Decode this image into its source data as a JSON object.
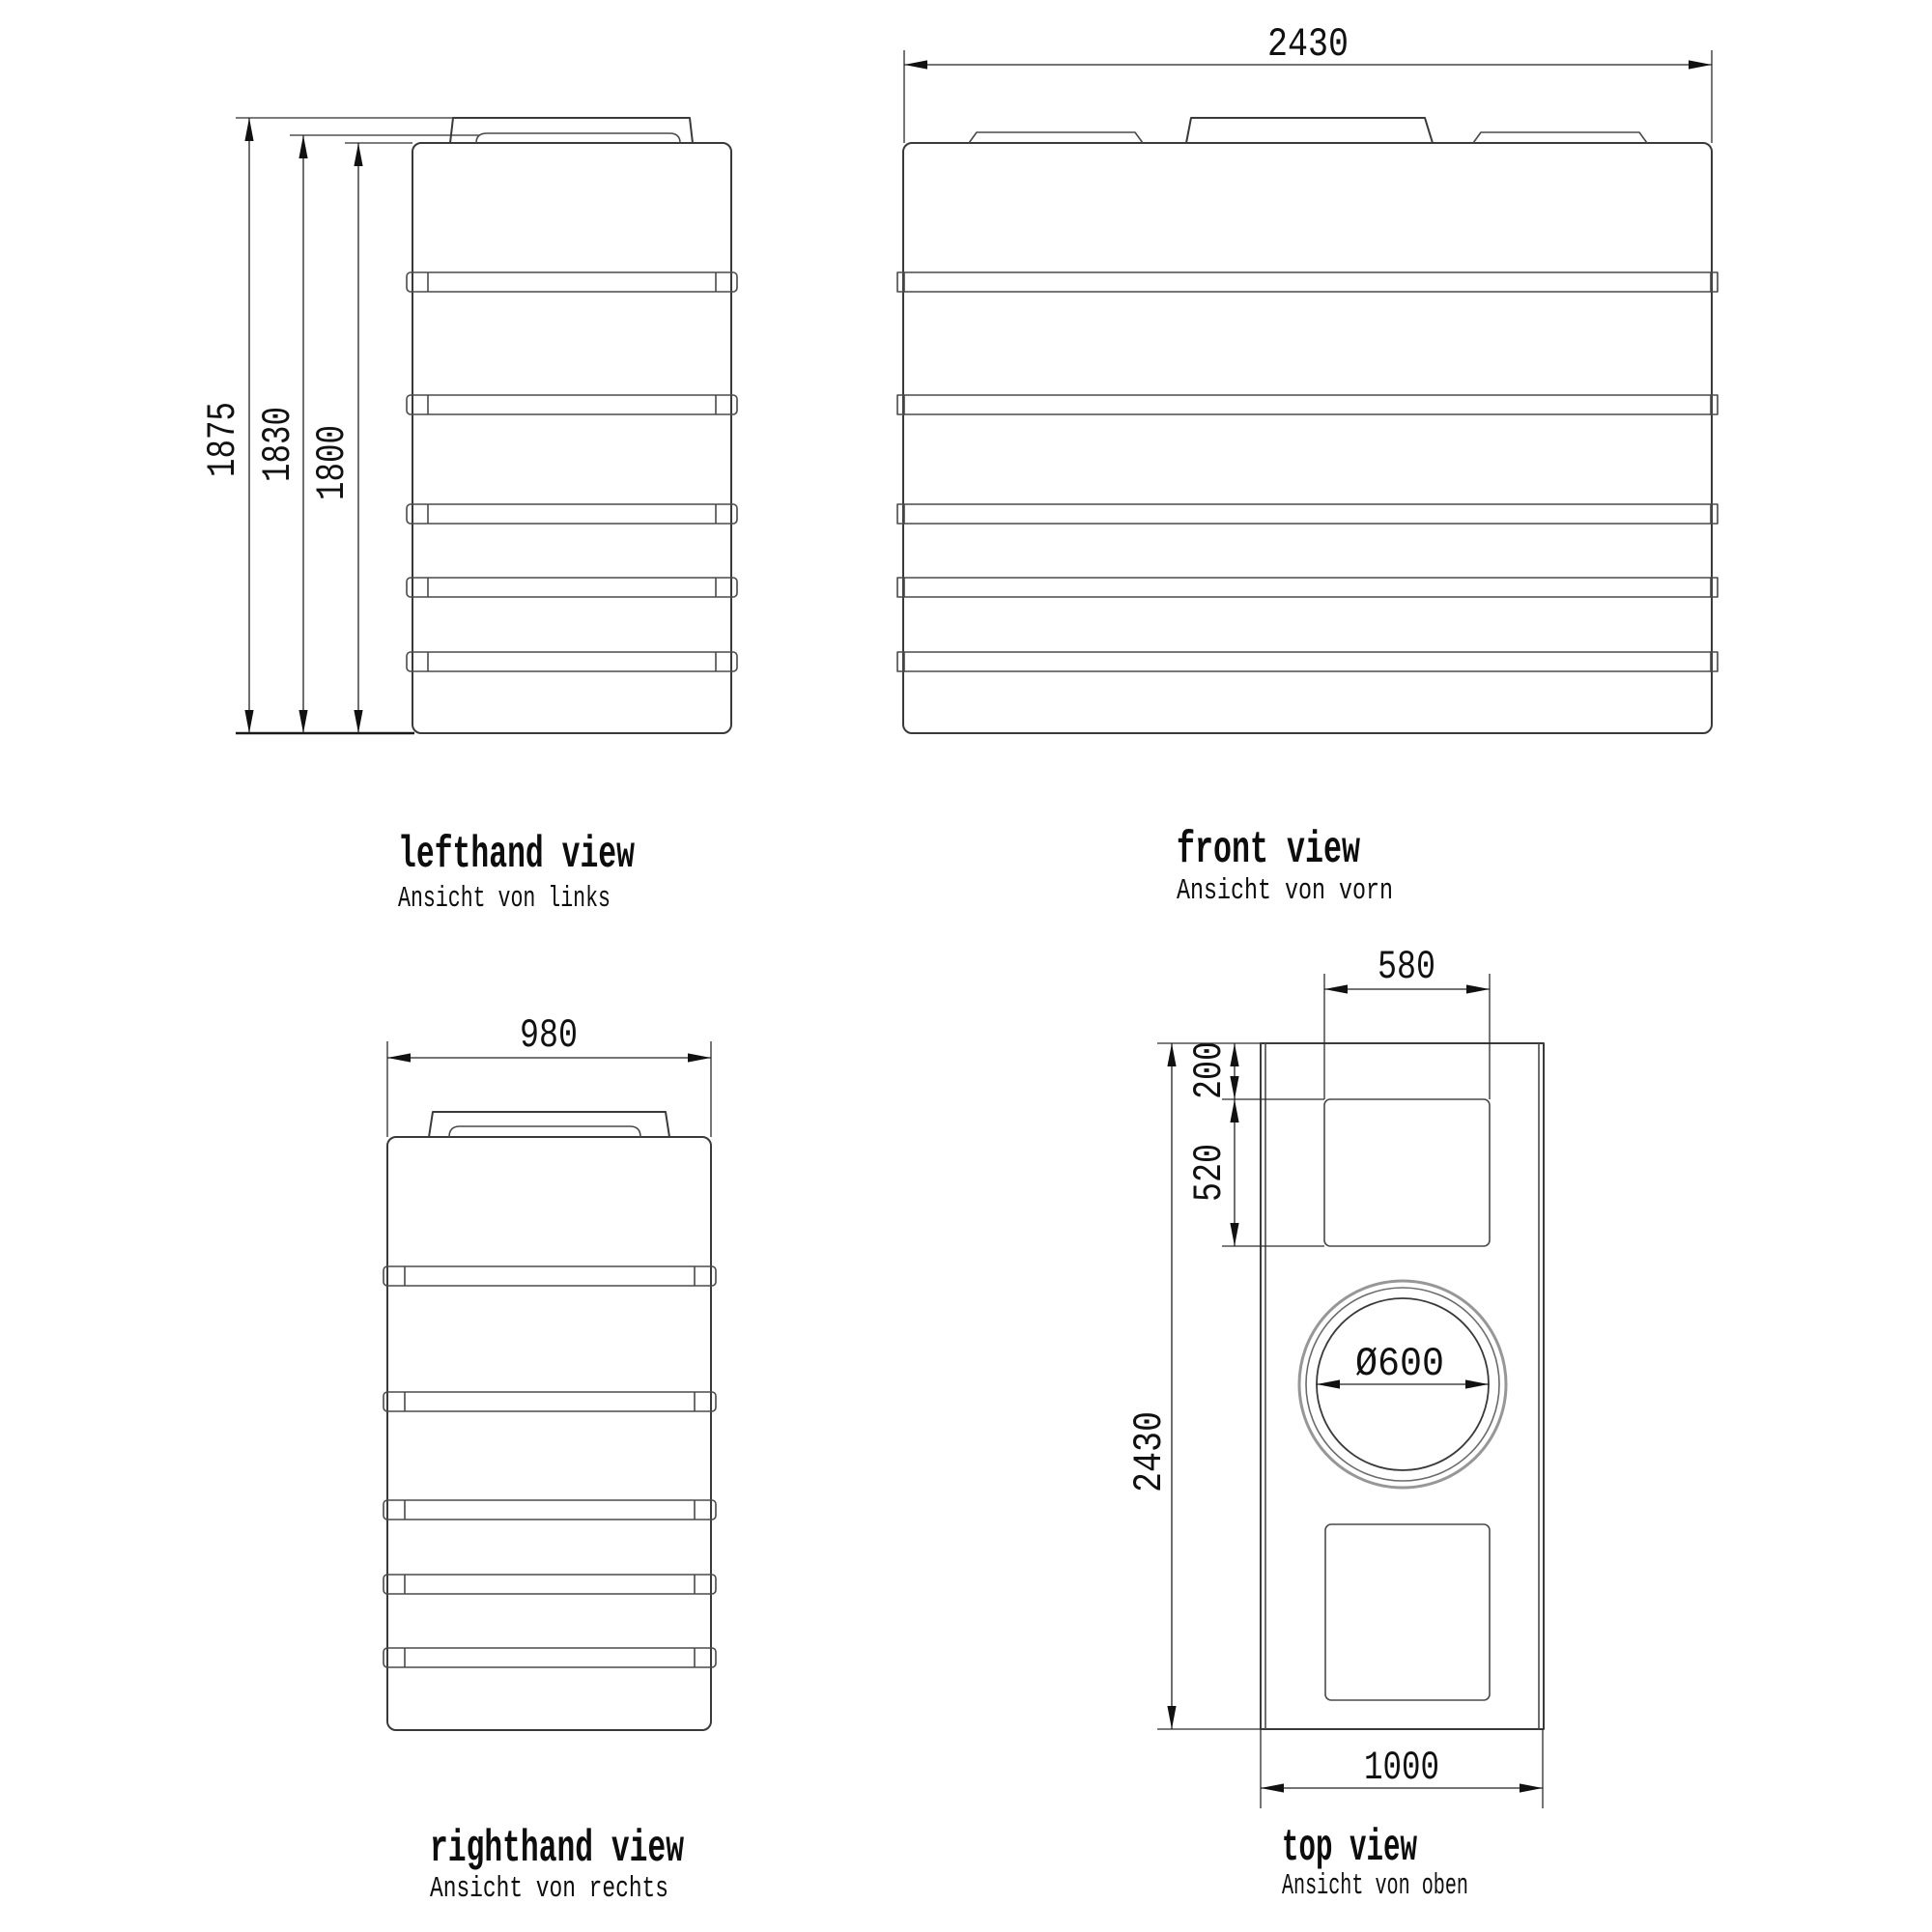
{
  "views": {
    "lefthand": {
      "label": "lefthand view",
      "sublabel": "Ansicht von links",
      "dim_overall_height": "1875",
      "dim_lid_height": "1830",
      "dim_body_height": "1800"
    },
    "front": {
      "label": "front view",
      "sublabel": "Ansicht von vorn",
      "dim_width": "2430"
    },
    "righthand": {
      "label": "righthand view",
      "sublabel": "Ansicht von rechts",
      "dim_depth": "980"
    },
    "top": {
      "label": "top view",
      "sublabel": "Ansicht von oben",
      "dim_recess_width": "580",
      "dim_recess_offset": "200",
      "dim_recess_depth": "520",
      "dim_length": "2430",
      "dim_manhole_diameter": "Ø600",
      "dim_width": "1000"
    }
  }
}
